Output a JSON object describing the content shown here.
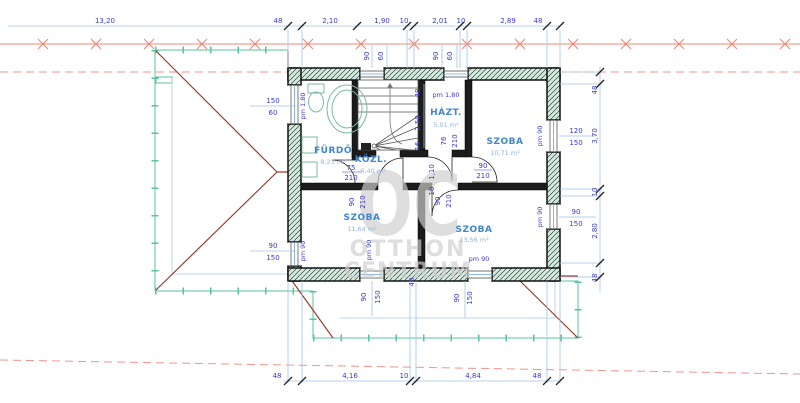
{
  "title": "floor-plan-drawing",
  "watermark": {
    "line1": "OC",
    "line2": "OTTHON",
    "line3": "CENTRUM"
  },
  "rooms": {
    "furdo": {
      "name": "FÜRDŐ",
      "area": "8,23 m²"
    },
    "hazt": {
      "name": "HÁZT.",
      "area": "5,01 m²"
    },
    "szoba1": {
      "name": "SZOBA",
      "area": "10,71 m²"
    },
    "kozl": {
      "name": "KÖZL.",
      "area": "6,40 m²"
    },
    "szoba2": {
      "name": "SZOBA",
      "area": "11,64 m²"
    },
    "szoba3": {
      "name": "SZOBA",
      "area": "13,56 m²"
    }
  },
  "dims": {
    "top": [
      "13,20",
      "48",
      "2,10",
      "1,90",
      "10",
      "2,01",
      "10",
      "2,89",
      "48"
    ],
    "bottom": [
      "48",
      "4,16",
      "10",
      "4,84",
      "48"
    ],
    "right": [
      "48",
      "3,70",
      "10",
      "2,80",
      "48"
    ],
    "win_left_upper": {
      "w": "150",
      "h": "60",
      "pm": "pm 1,80"
    },
    "win_left_lower": {
      "w": "90",
      "h": "150",
      "pm": "pm 90"
    },
    "win_top_1": {
      "w": "90",
      "h": "60"
    },
    "win_top_2": {
      "w": "90",
      "h": "60"
    },
    "win_right_upper": {
      "w": "120",
      "h": "150",
      "pm": "pm 90"
    },
    "win_right_lower": {
      "w": "90",
      "h": "150",
      "pm": "pm 90"
    },
    "win_bottom_1": {
      "w": "90",
      "h": "150",
      "pm": "pm 90"
    },
    "win_bottom_2": {
      "w": "90",
      "h": "150",
      "pm": "pm 90"
    },
    "door_furdo": {
      "w": "75",
      "h": "210"
    },
    "door_hazt": {
      "w": "76",
      "h": "210"
    },
    "door_szoba1": {
      "w": "90",
      "h": "210"
    },
    "door_szoba2": {
      "w": "90",
      "h": "210"
    },
    "door_szoba3": {
      "w": "90",
      "h": "210"
    },
    "stair": {
      "a": "48",
      "pm": "pm 1,80",
      "b": "2,50",
      "c": "16",
      "d": "1,10",
      "e": "10"
    },
    "wall": {
      "t": "48"
    }
  },
  "colors": {
    "dim_text": "#3a3acc",
    "dim_line": "#9fc4e6",
    "boundary": "#ef8877",
    "roof": "#9c3c30",
    "outline": "#58c3a0",
    "wall_fill": "#d4ebe0"
  }
}
